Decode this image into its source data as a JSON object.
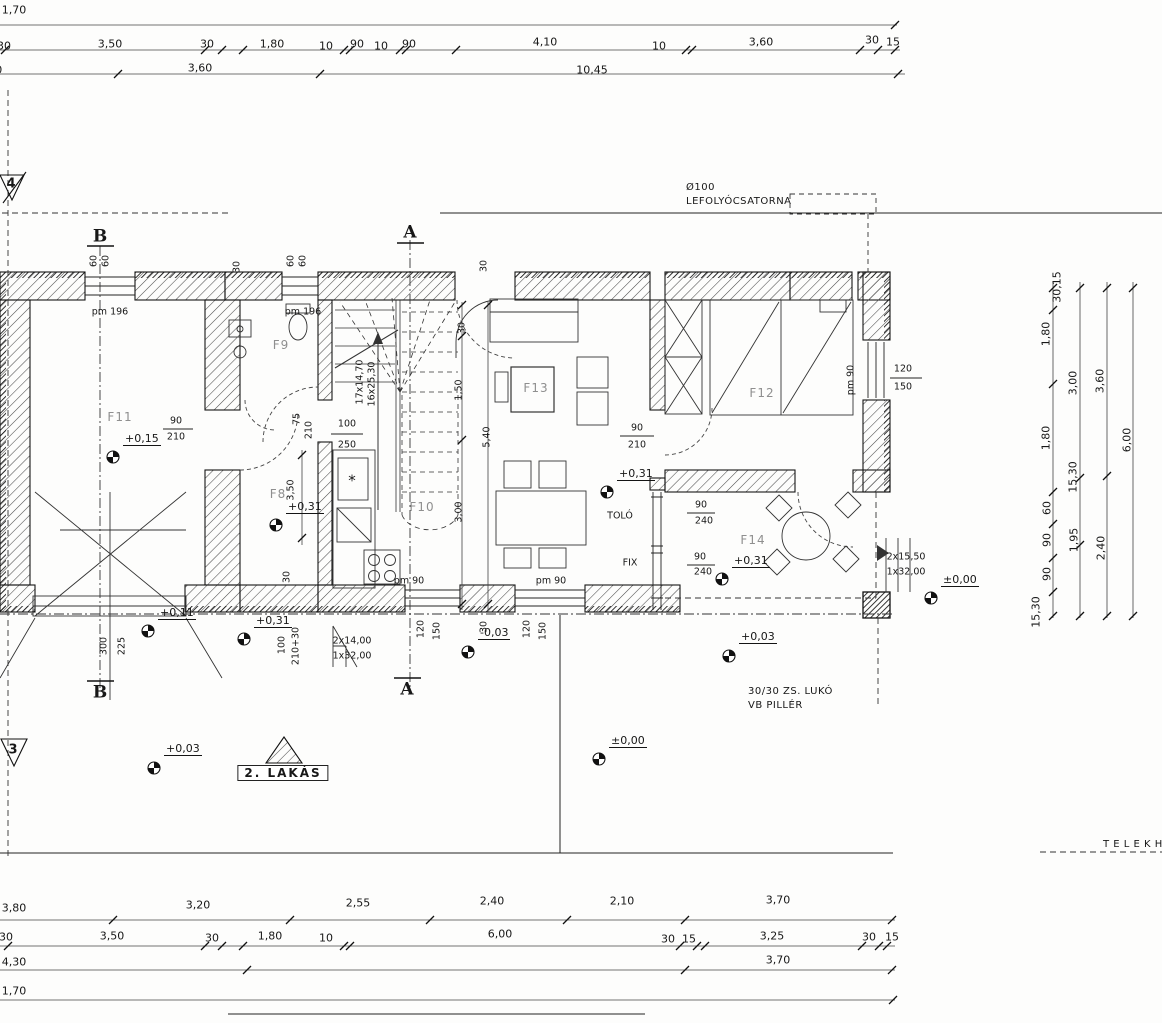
{
  "meta": {
    "drawing_type": "floor plan"
  },
  "colors": {
    "ink": "#171717",
    "faint": "#8f8f8f",
    "paper": "#fdfdfc"
  },
  "drawing": {
    "top_dims": [
      {
        "t": "1,70",
        "x": 14,
        "y": 10
      },
      {
        "t": "30",
        "x": 4,
        "y": 46
      },
      {
        "t": "3,50",
        "x": 110,
        "y": 44
      },
      {
        "t": "30",
        "x": 207,
        "y": 44
      },
      {
        "t": "1,80",
        "x": 272,
        "y": 44
      },
      {
        "t": "10",
        "x": 326,
        "y": 46
      },
      {
        "t": "90",
        "x": 357,
        "y": 44
      },
      {
        "t": "10",
        "x": 381,
        "y": 46
      },
      {
        "t": "90",
        "x": 409,
        "y": 44
      },
      {
        "t": "4,10",
        "x": 545,
        "y": 42
      },
      {
        "t": "10",
        "x": 659,
        "y": 46
      },
      {
        "t": "3,60",
        "x": 761,
        "y": 42
      },
      {
        "t": "30",
        "x": 872,
        "y": 40
      },
      {
        "t": "15",
        "x": 893,
        "y": 42
      },
      {
        "t": "3,80",
        "x": -10,
        "y": 70
      },
      {
        "t": "3,60",
        "x": 200,
        "y": 68
      },
      {
        "t": "10,45",
        "x": 592,
        "y": 70
      }
    ],
    "bottom_dims": [
      {
        "t": "3,80",
        "x": 14,
        "y": 908
      },
      {
        "t": "3,20",
        "x": 198,
        "y": 905
      },
      {
        "t": "2,55",
        "x": 358,
        "y": 903
      },
      {
        "t": "2,40",
        "x": 492,
        "y": 901
      },
      {
        "t": "2,10",
        "x": 622,
        "y": 901
      },
      {
        "t": "3,70",
        "x": 778,
        "y": 900
      },
      {
        "t": "30",
        "x": 6,
        "y": 937
      },
      {
        "t": "3,50",
        "x": 112,
        "y": 936
      },
      {
        "t": "30",
        "x": 212,
        "y": 938
      },
      {
        "t": "1,80",
        "x": 270,
        "y": 936
      },
      {
        "t": "10",
        "x": 326,
        "y": 938
      },
      {
        "t": "6,00",
        "x": 500,
        "y": 934
      },
      {
        "t": "30",
        "x": 668,
        "y": 939
      },
      {
        "t": "15",
        "x": 689,
        "y": 939
      },
      {
        "t": "3,25",
        "x": 772,
        "y": 936
      },
      {
        "t": "30",
        "x": 869,
        "y": 937
      },
      {
        "t": "15",
        "x": 892,
        "y": 937
      },
      {
        "t": "4,30",
        "x": 14,
        "y": 962
      },
      {
        "t": "3,70",
        "x": 778,
        "y": 960
      },
      {
        "t": "1,70",
        "x": 14,
        "y": 991
      }
    ],
    "right_dims": [
      {
        "t": "30,15",
        "x": 1057,
        "y": 287,
        "r": -90
      },
      {
        "t": "1,80",
        "x": 1046,
        "y": 334,
        "r": -90
      },
      {
        "t": "3,00",
        "x": 1073,
        "y": 383,
        "r": -90
      },
      {
        "t": "3,60",
        "x": 1100,
        "y": 381,
        "r": -90
      },
      {
        "t": "1,80",
        "x": 1046,
        "y": 438,
        "r": -90
      },
      {
        "t": "6,00",
        "x": 1127,
        "y": 440,
        "r": -90
      },
      {
        "t": "15,30",
        "x": 1073,
        "y": 477,
        "r": -90
      },
      {
        "t": "60",
        "x": 1047,
        "y": 508,
        "r": -90
      },
      {
        "t": "90",
        "x": 1047,
        "y": 540,
        "r": -90
      },
      {
        "t": "1,95",
        "x": 1074,
        "y": 540,
        "r": -90
      },
      {
        "t": "2,40",
        "x": 1101,
        "y": 548,
        "r": -90
      },
      {
        "t": "90",
        "x": 1047,
        "y": 574,
        "r": -90
      },
      {
        "t": "15,30",
        "x": 1036,
        "y": 612,
        "r": -90
      }
    ],
    "inner_dims": [
      {
        "t": "60",
        "x": 94,
        "y": 261,
        "r": -90
      },
      {
        "t": "60",
        "x": 106,
        "y": 261,
        "r": -90
      },
      {
        "t": "30",
        "x": 237,
        "y": 267,
        "r": -90
      },
      {
        "t": "60",
        "x": 291,
        "y": 261,
        "r": -90
      },
      {
        "t": "60",
        "x": 303,
        "y": 261,
        "r": -90
      },
      {
        "t": "30",
        "x": 484,
        "y": 266,
        "r": -90
      },
      {
        "t": "30",
        "x": 462,
        "y": 328,
        "r": -90
      },
      {
        "t": "1,50",
        "x": 459,
        "y": 390,
        "r": -90
      },
      {
        "t": "5,40",
        "x": 487,
        "y": 437,
        "r": -90
      },
      {
        "t": "3,00",
        "x": 459,
        "y": 512,
        "r": -90
      },
      {
        "t": "3,50",
        "x": 291,
        "y": 490,
        "r": -90
      },
      {
        "t": "30",
        "x": 287,
        "y": 577,
        "r": -90
      },
      {
        "t": "75",
        "x": 297,
        "y": 419,
        "r": -90
      },
      {
        "t": "210",
        "x": 309,
        "y": 430,
        "r": -90
      },
      {
        "t": "120",
        "x": 421,
        "y": 629,
        "r": -90
      },
      {
        "t": "150",
        "x": 437,
        "y": 631,
        "r": -90
      },
      {
        "t": "120",
        "x": 527,
        "y": 629,
        "r": -90
      },
      {
        "t": "150",
        "x": 543,
        "y": 631,
        "r": -90
      },
      {
        "t": "100",
        "x": 282,
        "y": 645,
        "r": -90
      },
      {
        "t": "210+30",
        "x": 296,
        "y": 646,
        "r": -90
      },
      {
        "t": "300",
        "x": 104,
        "y": 646,
        "r": -90
      },
      {
        "t": "225",
        "x": 122,
        "y": 646,
        "r": -90
      },
      {
        "t": "30",
        "x": 484,
        "y": 627,
        "r": -90
      },
      {
        "t": "pm 90",
        "x": 851,
        "y": 380,
        "r": -90
      },
      {
        "t": "17x14,70",
        "x": 360,
        "y": 382,
        "r": -90
      },
      {
        "t": "16x25,30",
        "x": 372,
        "y": 384,
        "r": -90
      }
    ],
    "specs": [
      {
        "t": "pm 196",
        "x": 110,
        "y": 312
      },
      {
        "t": "pm 196",
        "x": 303,
        "y": 312
      },
      {
        "t": "90",
        "x": 176,
        "y": 421
      },
      {
        "t": "210",
        "x": 176,
        "y": 437
      },
      {
        "t": "100",
        "x": 347,
        "y": 424
      },
      {
        "t": "250",
        "x": 347,
        "y": 445
      },
      {
        "t": "90",
        "x": 637,
        "y": 428
      },
      {
        "t": "210",
        "x": 637,
        "y": 445
      },
      {
        "t": "90",
        "x": 701,
        "y": 505
      },
      {
        "t": "240",
        "x": 704,
        "y": 521
      },
      {
        "t": "90",
        "x": 700,
        "y": 557
      },
      {
        "t": "240",
        "x": 703,
        "y": 572
      },
      {
        "t": "FIX",
        "x": 630,
        "y": 563
      },
      {
        "t": "TOLÓ",
        "x": 620,
        "y": 516
      },
      {
        "t": "pm 90",
        "x": 409,
        "y": 581
      },
      {
        "t": "pm 90",
        "x": 551,
        "y": 581
      },
      {
        "t": "120",
        "x": 903,
        "y": 369
      },
      {
        "t": "150",
        "x": 903,
        "y": 387
      },
      {
        "t": "2x15,50",
        "x": 906,
        "y": 557
      },
      {
        "t": "1x32,00",
        "x": 906,
        "y": 572
      },
      {
        "t": "2x14,00",
        "x": 352,
        "y": 641
      },
      {
        "t": "1x32,00",
        "x": 352,
        "y": 656
      },
      {
        "t": "*",
        "x": 352,
        "y": 481,
        "s": 15
      }
    ],
    "rooms": [
      {
        "t": "F11",
        "x": 120,
        "y": 417,
        "n": "room-label-f11"
      },
      {
        "t": "F9",
        "x": 281,
        "y": 345,
        "n": "room-label-f9"
      },
      {
        "t": "F8",
        "x": 278,
        "y": 494,
        "n": "room-label-f8"
      },
      {
        "t": "F10",
        "x": 422,
        "y": 507,
        "n": "room-label-f10"
      },
      {
        "t": "F13",
        "x": 536,
        "y": 388,
        "n": "room-label-f13"
      },
      {
        "t": "F12",
        "x": 762,
        "y": 393,
        "n": "room-label-f12"
      },
      {
        "t": "F14",
        "x": 753,
        "y": 540,
        "n": "room-label-f14"
      }
    ],
    "levels": [
      {
        "t": "+0,15",
        "x": 123,
        "y": 446,
        "cx": 113,
        "cy": 457
      },
      {
        "t": "+0,31",
        "x": 286,
        "y": 514,
        "cx": 276,
        "cy": 525
      },
      {
        "t": "+0,31",
        "x": 254,
        "y": 628,
        "cx": 244,
        "cy": 639
      },
      {
        "t": "+0,31",
        "x": 617,
        "y": 481,
        "cx": 607,
        "cy": 492
      },
      {
        "t": "+0,31",
        "x": 732,
        "y": 568,
        "cx": 722,
        "cy": 579
      },
      {
        "t": "+0,11",
        "x": 158,
        "y": 620,
        "cx": 148,
        "cy": 631
      },
      {
        "t": "-0,03",
        "x": 478,
        "y": 640,
        "cx": 468,
        "cy": 652
      },
      {
        "t": "+0,03",
        "x": 739,
        "y": 644,
        "cx": 729,
        "cy": 656
      },
      {
        "t": "+0,03",
        "x": 164,
        "y": 756,
        "cx": 154,
        "cy": 768
      },
      {
        "t": "±0,00",
        "x": 609,
        "y": 748,
        "cx": 599,
        "cy": 759
      },
      {
        "t": "±0,00",
        "x": 941,
        "y": 587,
        "cx": 931,
        "cy": 598
      }
    ],
    "annotations": [
      {
        "t": "Ø100",
        "x": 686,
        "y": 188,
        "a": "l",
        "n": "drain-size-label"
      },
      {
        "t": "LEFOLYÓCSATORNA",
        "x": 686,
        "y": 202,
        "a": "l",
        "n": "drain-label"
      },
      {
        "t": "30/30 ZS. LUKÓ",
        "x": 748,
        "y": 692,
        "a": "l",
        "n": "pillar-label-1"
      },
      {
        "t": "VB PILLÉR",
        "x": 748,
        "y": 706,
        "a": "l",
        "n": "pillar-label-2"
      },
      {
        "t": "T E L E K H A T Á R",
        "x": 1103,
        "y": 845,
        "a": "l",
        "n": "site-boundary-label"
      }
    ],
    "unit_label": {
      "t": "2. LAKÁS",
      "x": 283,
      "y": 773,
      "n": "unit-label"
    },
    "sections": [
      {
        "t": "B",
        "x": 100,
        "y": 237,
        "n": "section-mark-b-top"
      },
      {
        "t": "B",
        "x": 100,
        "y": 693,
        "n": "section-mark-b-bottom"
      },
      {
        "t": "A",
        "x": 410,
        "y": 233,
        "n": "section-mark-a-top"
      },
      {
        "t": "A",
        "x": 407,
        "y": 690,
        "n": "section-mark-a-bottom"
      }
    ],
    "site_marks": [
      {
        "t": "4",
        "x": 11,
        "y": 184,
        "n": "site-point-4"
      },
      {
        "t": "3",
        "x": 13,
        "y": 750,
        "n": "site-point-3"
      }
    ]
  }
}
